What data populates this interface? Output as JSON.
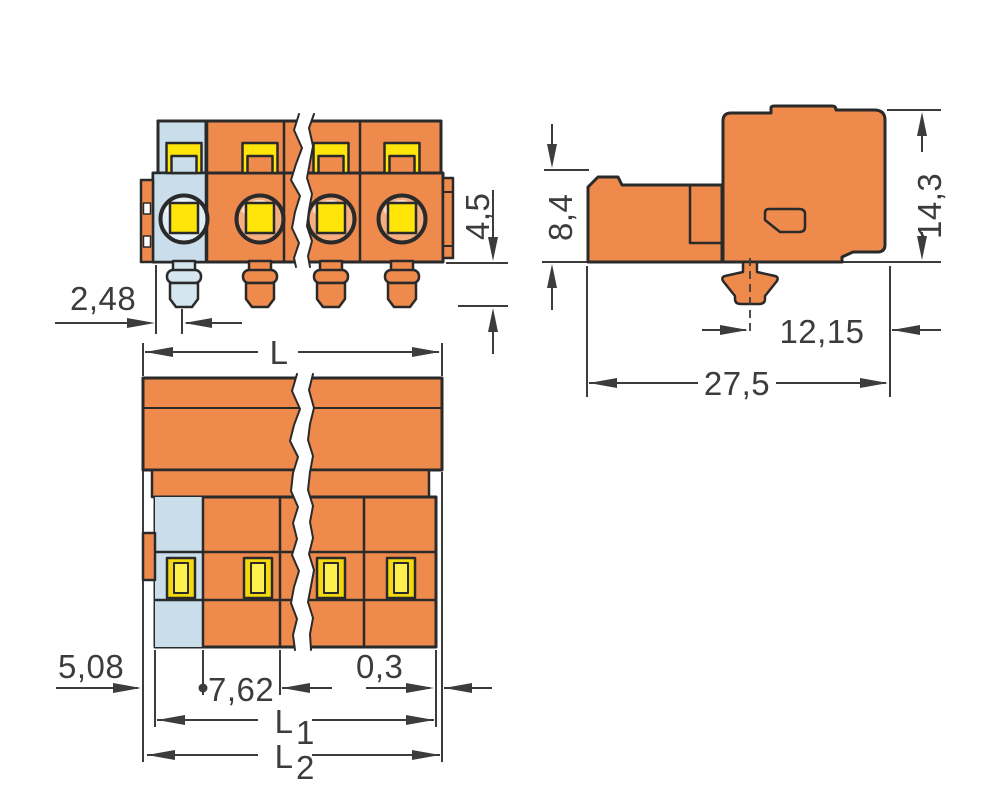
{
  "colors": {
    "background": "#ffffff",
    "housing": "#EF8A4D",
    "housing_light": "#F5AE80",
    "coding": "#C9DEEA",
    "coding_light": "#E0EDF4",
    "pin_coding": "#D5E6F0",
    "contact_yellow": "#FFE50A",
    "contact_outer": "#F4D90C",
    "contact_inner": "#FFF04D",
    "outline": "#2A2A2A",
    "dim": "#3C3C3C"
  },
  "dims": {
    "front": {
      "pin_offset": "2,48",
      "pin_length": "4,5"
    },
    "side": {
      "front_height": "8,4",
      "total_height": "14,3",
      "foot_to_rear": "12,15",
      "depth": "27,5"
    },
    "top": {
      "length": "L",
      "first_pitch": "5,08",
      "pitch": "7,62",
      "flange": "0,3",
      "l1": "L",
      "l1_sub": "1",
      "l2": "L",
      "l2_sub": "2"
    }
  }
}
